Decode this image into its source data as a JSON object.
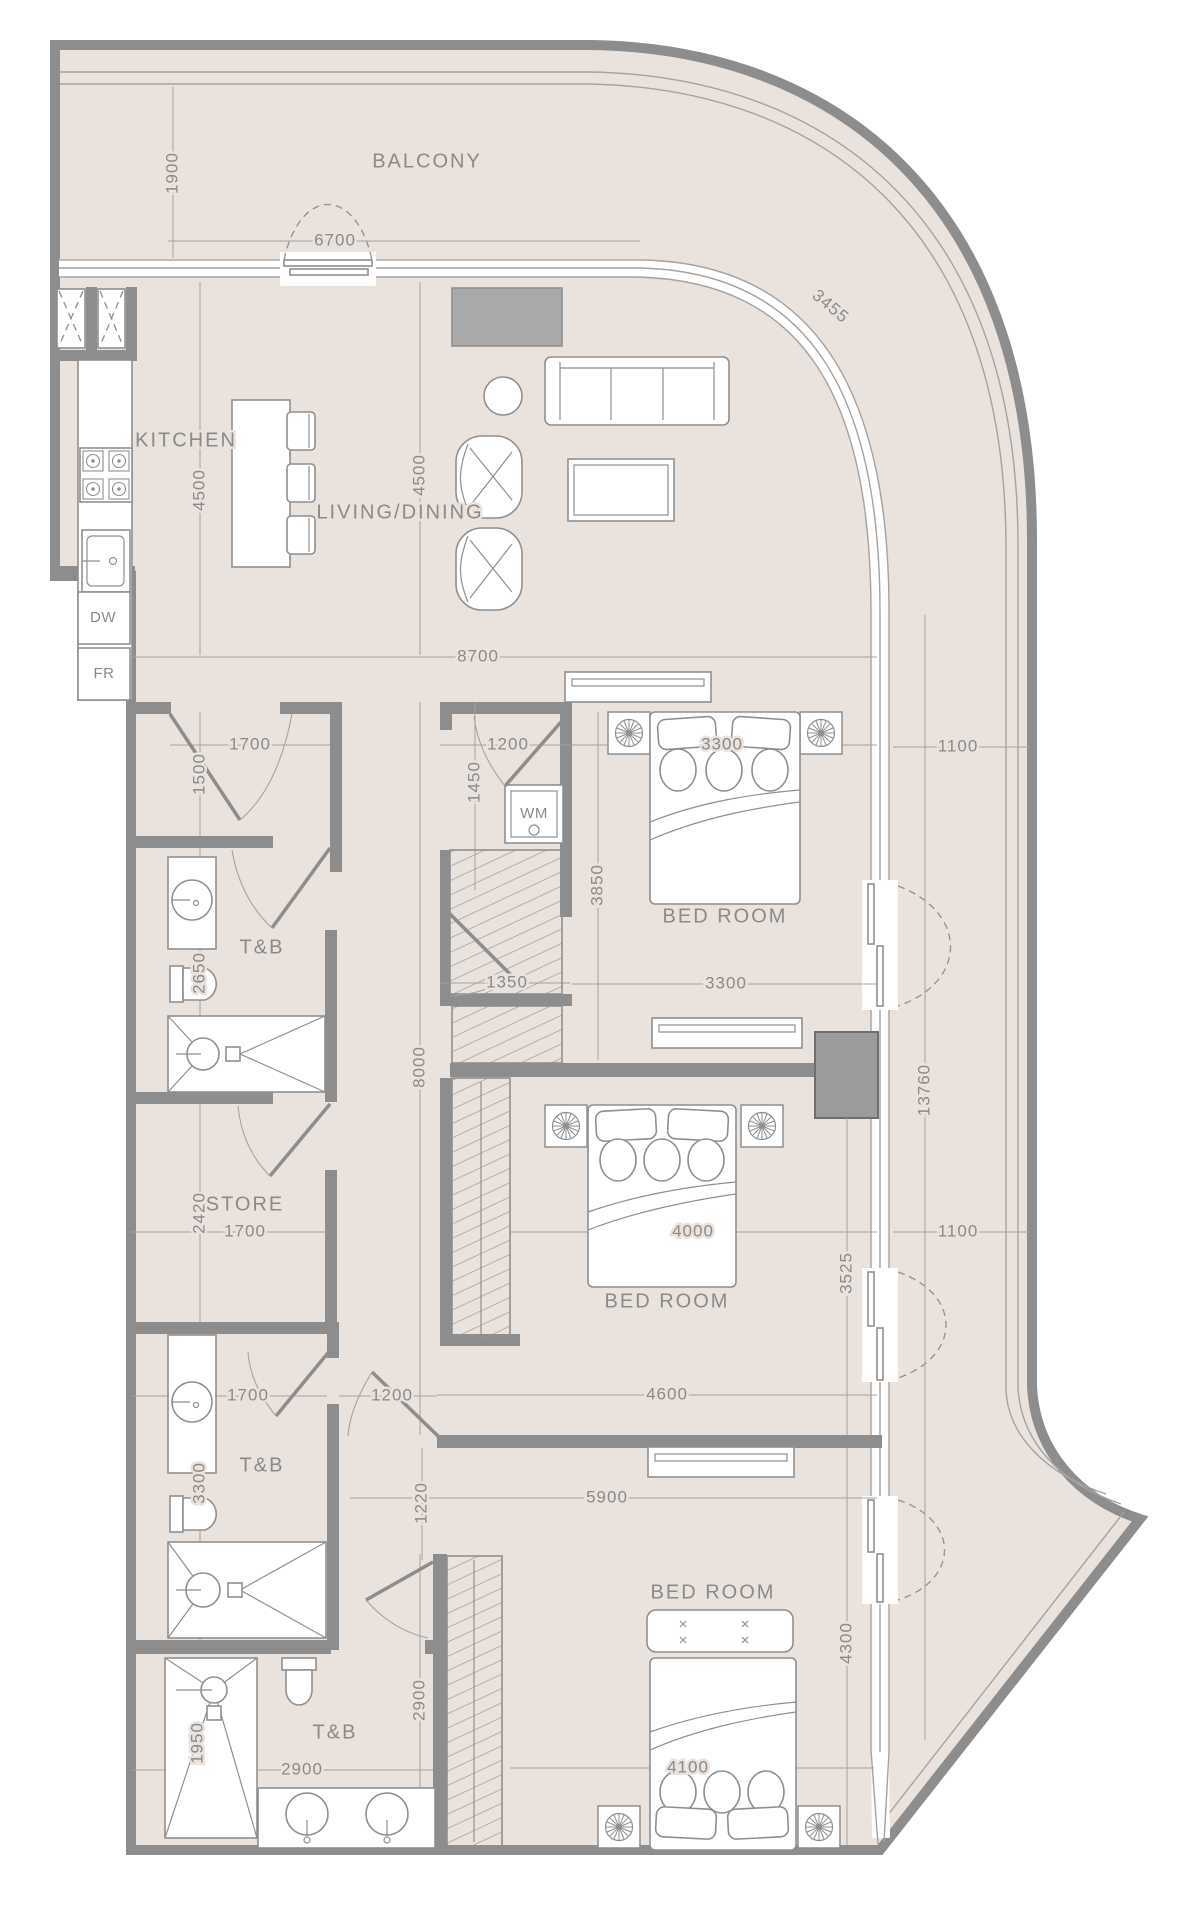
{
  "colors": {
    "floor": "#eae2dc",
    "wall": "#8d8d8d",
    "line": "#8f8f8f",
    "line_light": "#a6a2a0",
    "accent_gray": "#a9a9a9",
    "text": "#8a8a8a",
    "background": "#ffffff"
  },
  "labels": {
    "rooms": [
      {
        "text": "BALCONY",
        "x": 427,
        "y": 162,
        "rot": 0
      },
      {
        "text": "KITCHEN",
        "x": 186,
        "y": 441,
        "rot": 0
      },
      {
        "text": "LIVING/DINING",
        "x": 400,
        "y": 513,
        "rot": 0
      },
      {
        "text": "BED ROOM",
        "x": 725,
        "y": 917,
        "rot": 0
      },
      {
        "text": "BED ROOM",
        "x": 667,
        "y": 1302,
        "rot": 0
      },
      {
        "text": "BED ROOM",
        "x": 713,
        "y": 1593,
        "rot": 0
      },
      {
        "text": "T&B",
        "x": 262,
        "y": 948,
        "rot": 0
      },
      {
        "text": "T&B",
        "x": 262,
        "y": 1466,
        "rot": 0
      },
      {
        "text": "T&B",
        "x": 335,
        "y": 1733,
        "rot": 0
      },
      {
        "text": "STORE",
        "x": 245,
        "y": 1205,
        "rot": 0
      }
    ],
    "dims": [
      {
        "text": "1900",
        "x": 173,
        "y": 173,
        "rot": -90
      },
      {
        "text": "6700",
        "x": 335,
        "y": 241,
        "rot": 0
      },
      {
        "text": "3455",
        "x": 830,
        "y": 307,
        "rot": 40
      },
      {
        "text": "4500",
        "x": 200,
        "y": 490,
        "rot": -90
      },
      {
        "text": "4500",
        "x": 420,
        "y": 475,
        "rot": -90
      },
      {
        "text": "8700",
        "x": 478,
        "y": 657,
        "rot": 0
      },
      {
        "text": "1700",
        "x": 250,
        "y": 745,
        "rot": 0
      },
      {
        "text": "1500",
        "x": 200,
        "y": 774,
        "rot": -90
      },
      {
        "text": "1200",
        "x": 508,
        "y": 745,
        "rot": 0
      },
      {
        "text": "1450",
        "x": 475,
        "y": 782,
        "rot": -90
      },
      {
        "text": "3300",
        "x": 722,
        "y": 745,
        "rot": 0
      },
      {
        "text": "1100",
        "x": 958,
        "y": 747,
        "rot": 0
      },
      {
        "text": "3850",
        "x": 598,
        "y": 885,
        "rot": -90
      },
      {
        "text": "3300",
        "x": 726,
        "y": 984,
        "rot": 0
      },
      {
        "text": "2650",
        "x": 200,
        "y": 973,
        "rot": -90
      },
      {
        "text": "1350",
        "x": 507,
        "y": 983,
        "rot": 0
      },
      {
        "text": "8000",
        "x": 420,
        "y": 1067,
        "rot": -90
      },
      {
        "text": "2420",
        "x": 200,
        "y": 1213,
        "rot": -90
      },
      {
        "text": "1700",
        "x": 245,
        "y": 1232,
        "rot": 0
      },
      {
        "text": "4000",
        "x": 693,
        "y": 1232,
        "rot": 0
      },
      {
        "text": "13760",
        "x": 925,
        "y": 1090,
        "rot": -90
      },
      {
        "text": "1100",
        "x": 958,
        "y": 1232,
        "rot": 0
      },
      {
        "text": "3525",
        "x": 847,
        "y": 1273,
        "rot": -90
      },
      {
        "text": "1700",
        "x": 248,
        "y": 1396,
        "rot": 0
      },
      {
        "text": "1200",
        "x": 392,
        "y": 1396,
        "rot": 0
      },
      {
        "text": "4600",
        "x": 667,
        "y": 1395,
        "rot": 0
      },
      {
        "text": "3300",
        "x": 200,
        "y": 1483,
        "rot": -90
      },
      {
        "text": "1220",
        "x": 422,
        "y": 1503,
        "rot": -90
      },
      {
        "text": "5900",
        "x": 607,
        "y": 1498,
        "rot": 0
      },
      {
        "text": "2900",
        "x": 420,
        "y": 1700,
        "rot": -90
      },
      {
        "text": "4300",
        "x": 847,
        "y": 1643,
        "rot": -90
      },
      {
        "text": "4100",
        "x": 688,
        "y": 1768,
        "rot": 0
      },
      {
        "text": "1950",
        "x": 198,
        "y": 1743,
        "rot": -90
      },
      {
        "text": "2900",
        "x": 302,
        "y": 1770,
        "rot": 0
      }
    ],
    "appliances": [
      {
        "text": "WM",
        "x": 534,
        "y": 814,
        "rot": 0
      },
      {
        "text": "DW",
        "x": 103,
        "y": 618,
        "rot": 0
      },
      {
        "text": "FR",
        "x": 104,
        "y": 674,
        "rot": 0
      }
    ]
  }
}
